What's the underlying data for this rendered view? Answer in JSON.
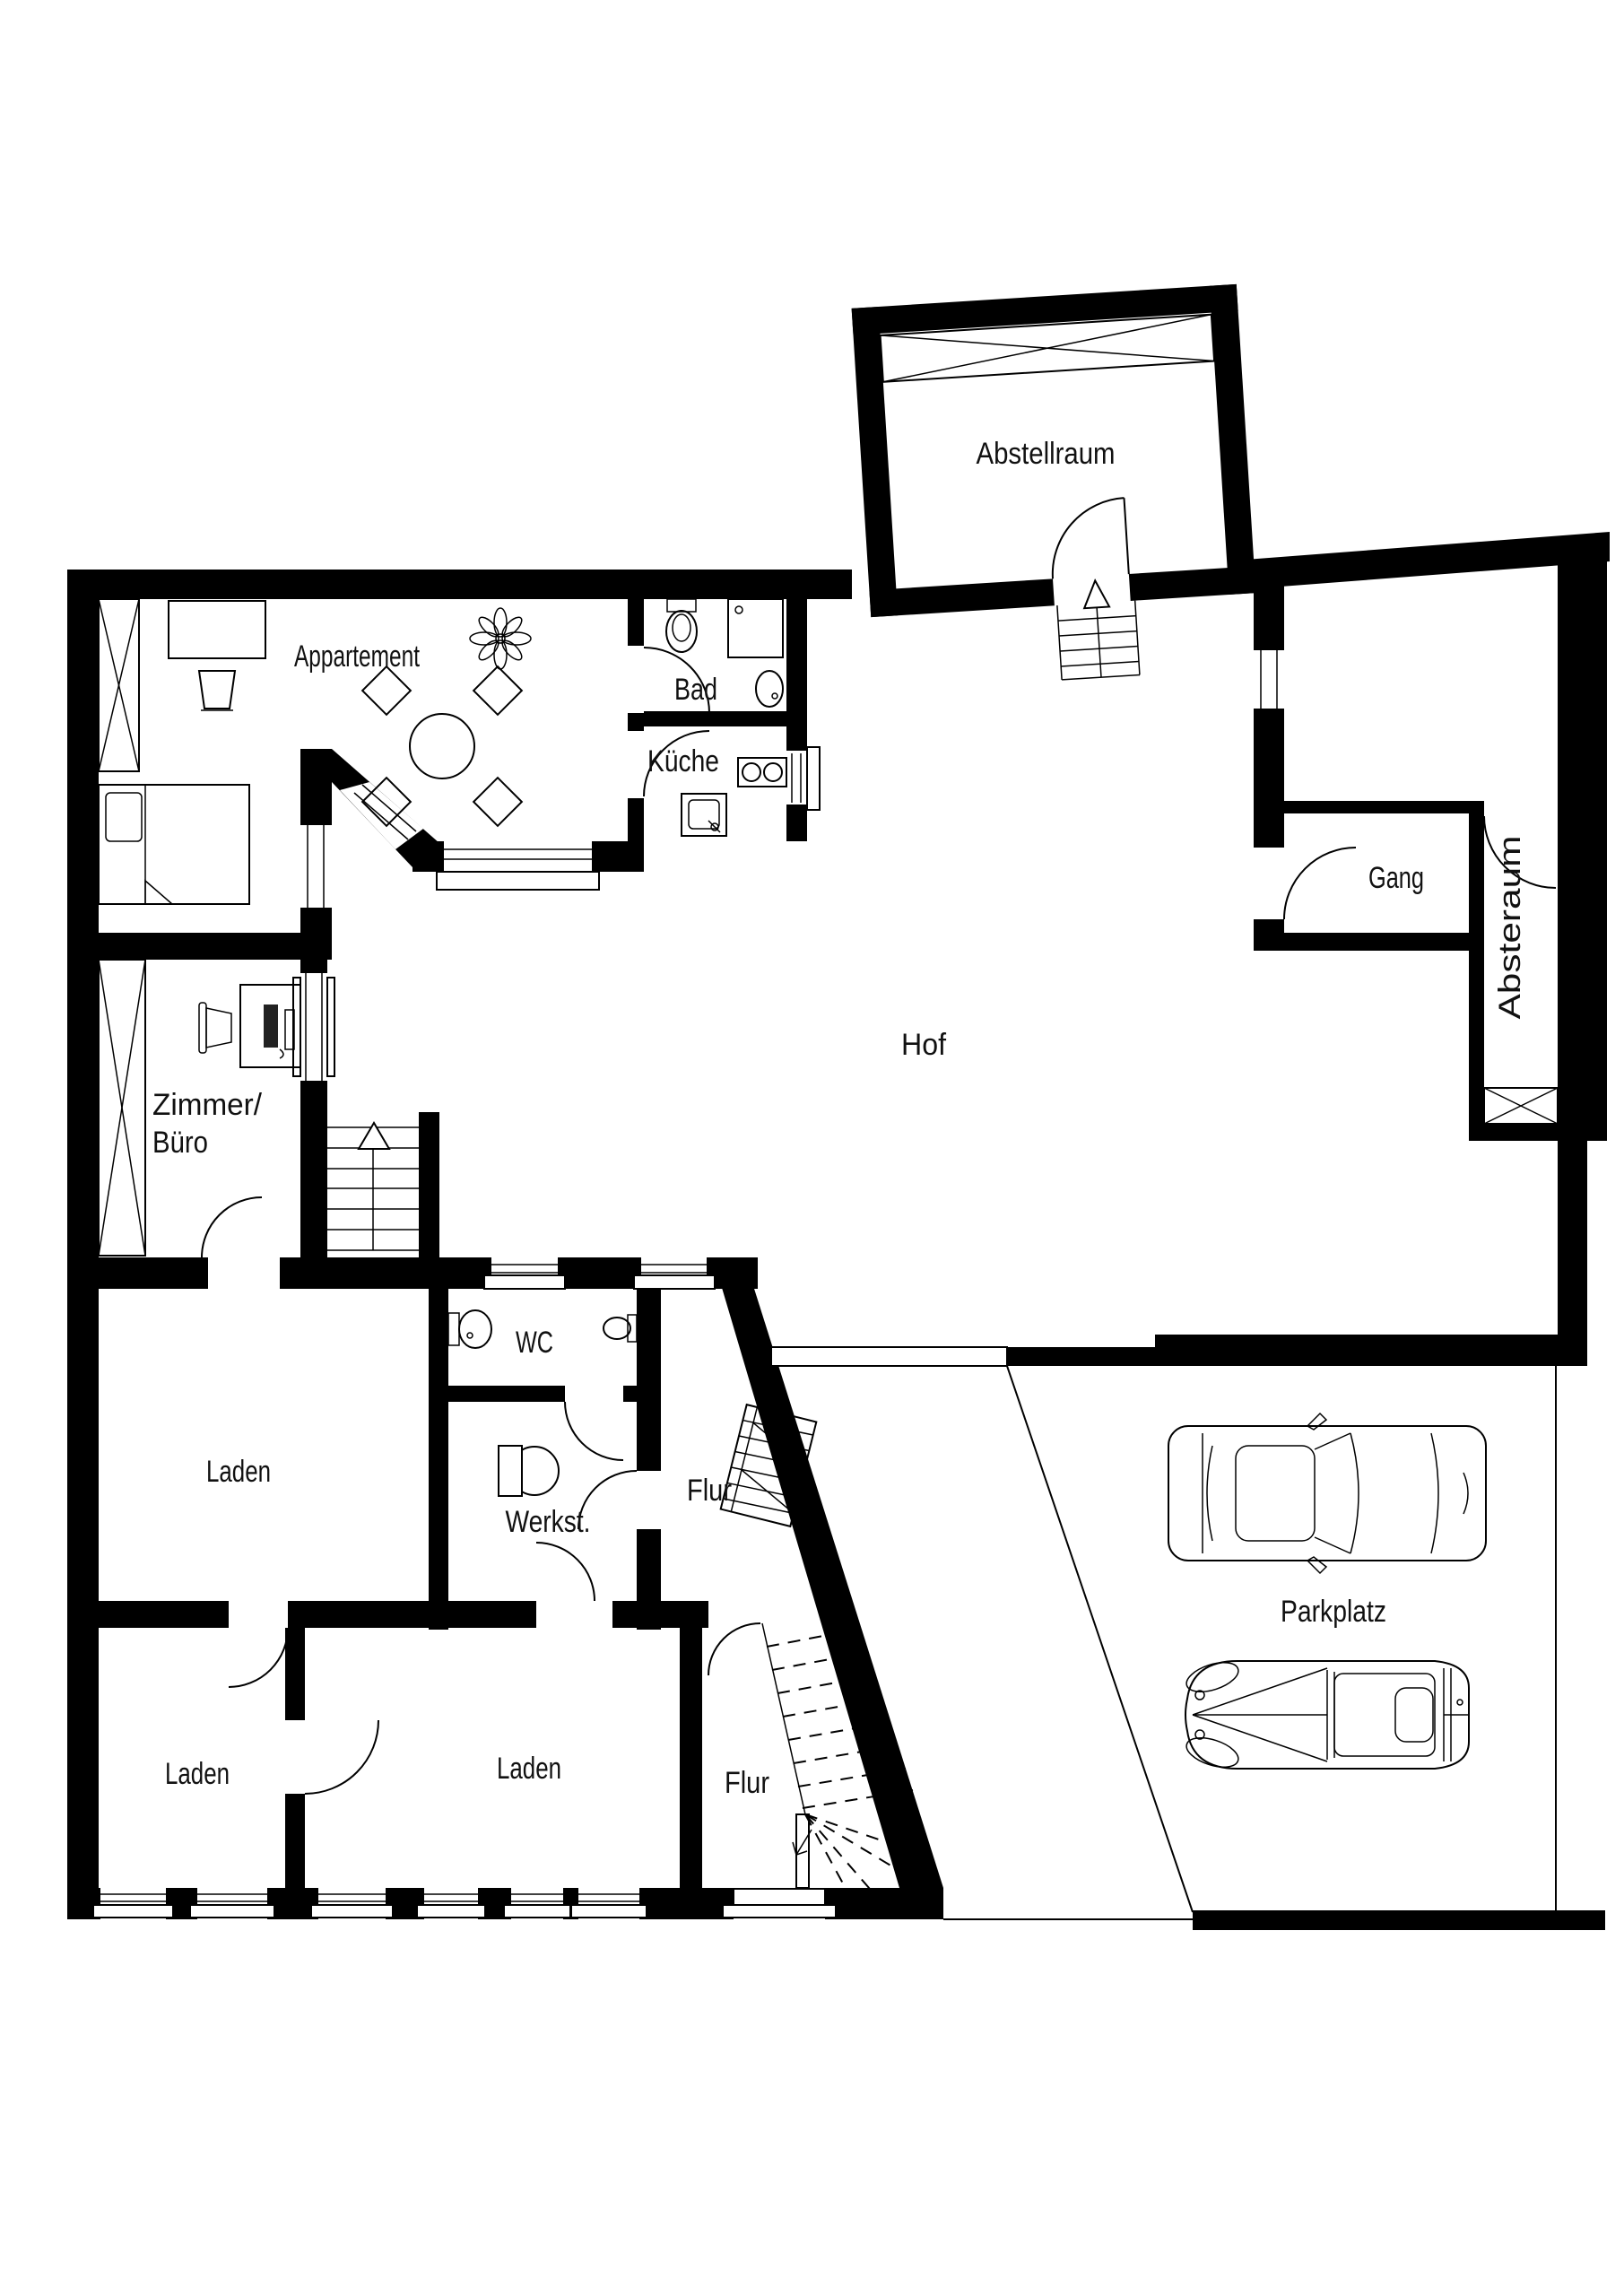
{
  "plan": {
    "type": "floor-plan",
    "background": "#ffffff",
    "wall_color": "#000000",
    "line_color": "#000000",
    "text_color": "#111111"
  },
  "labels": {
    "abstellraum": "Abstellraum",
    "appartement": "Appartement",
    "bad": "Bad",
    "kueche": "Küche",
    "gang": "Gang",
    "absteraum": "Absteraum",
    "hof": "Hof",
    "zimmer_line1": "Zimmer/",
    "zimmer_line2": "Büro",
    "laden_upper": "Laden",
    "laden_lower_left": "Laden",
    "laden_lower_mid": "Laden",
    "wc": "WC",
    "werkstatt": "Werkst.",
    "flur_mid": "Flur",
    "flur_lower": "Flur",
    "parkplatz": "Parkplatz"
  }
}
